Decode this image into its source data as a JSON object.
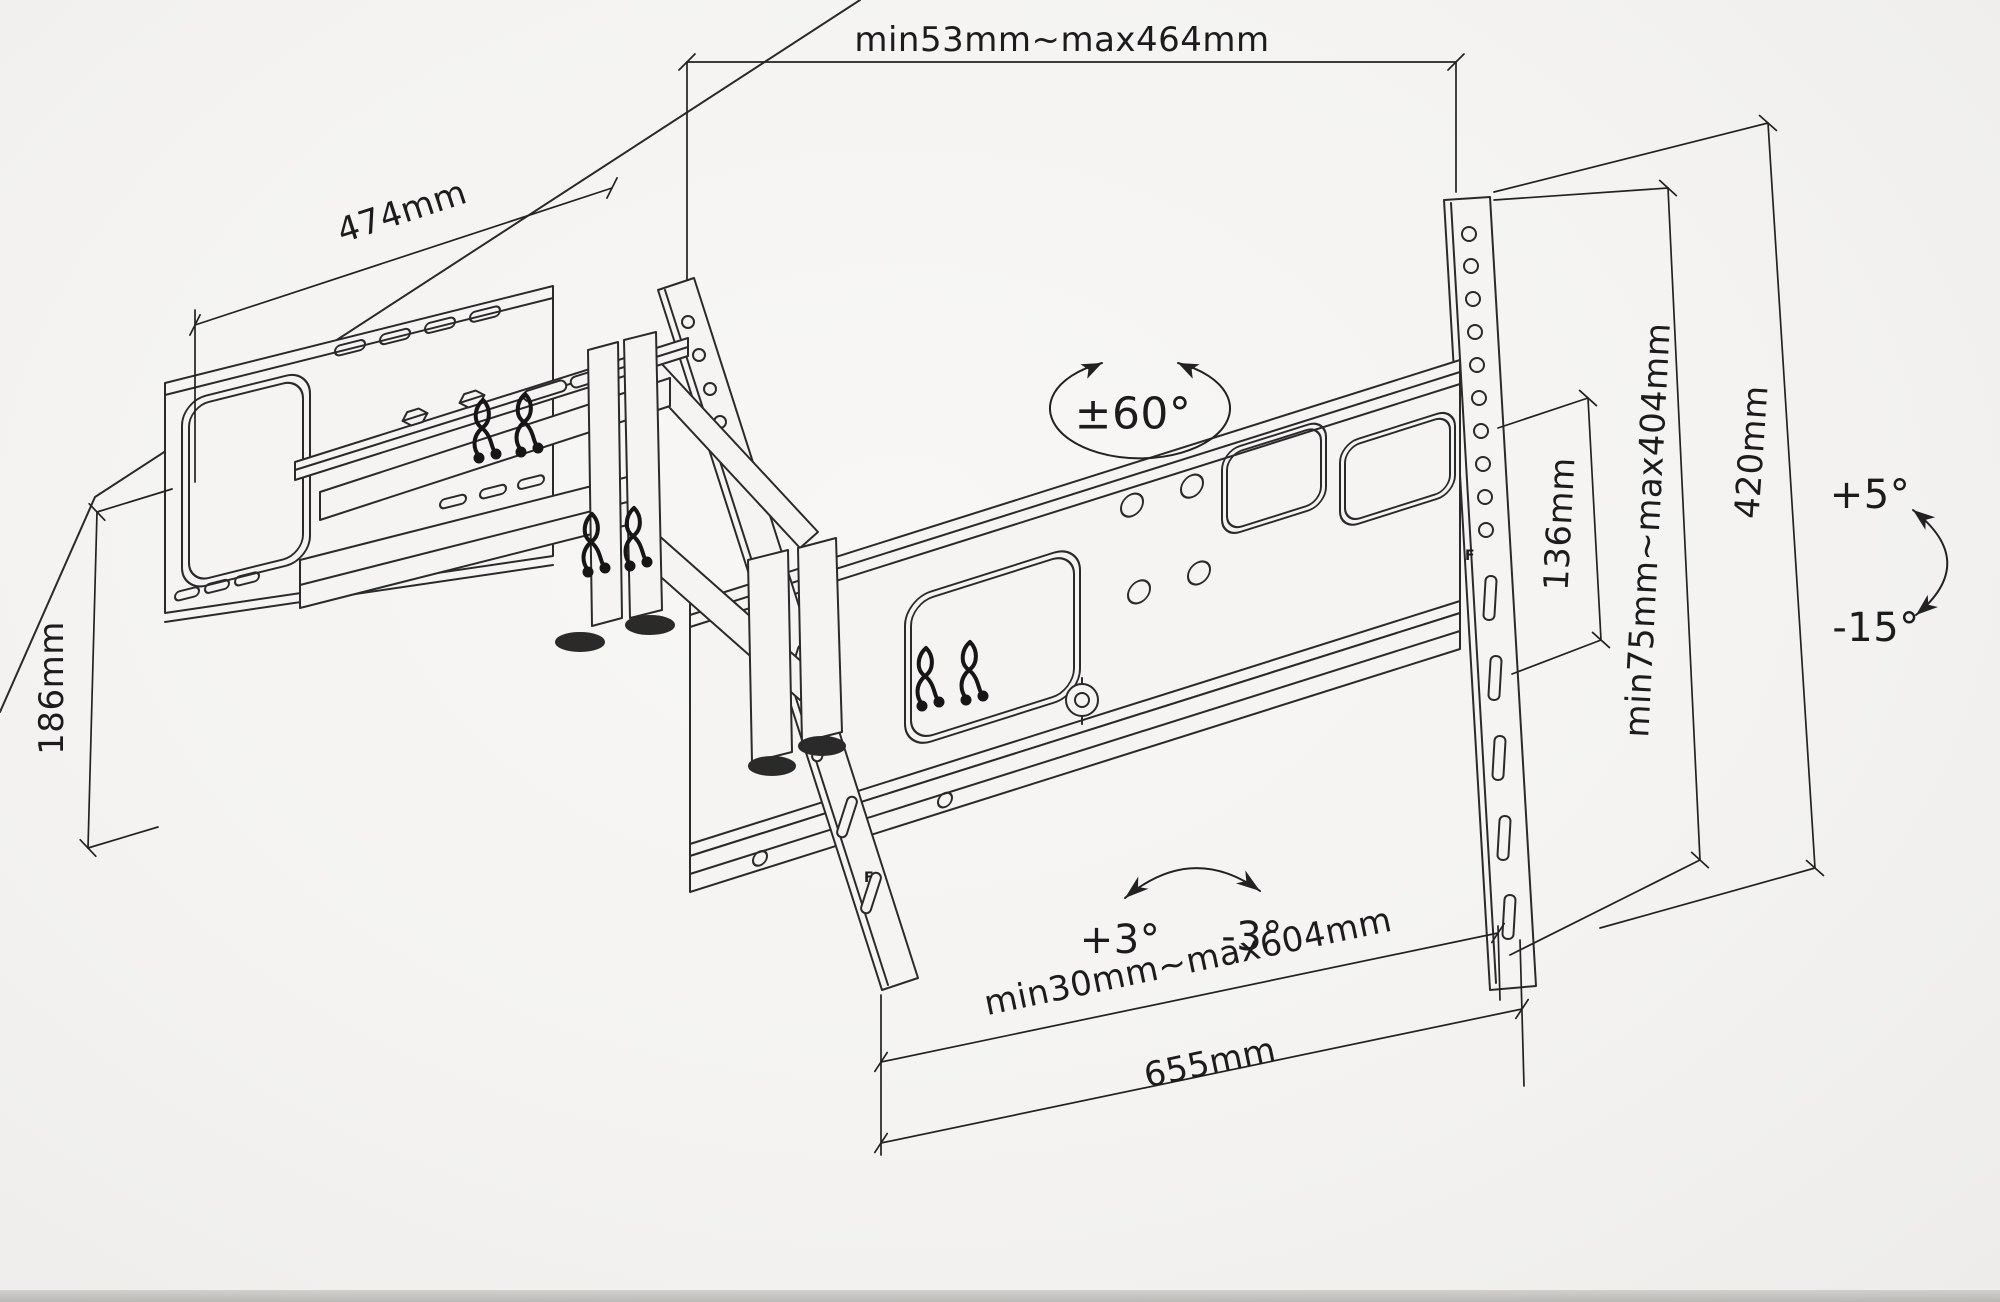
{
  "diagram": {
    "dimensions": {
      "top_span": "min53mm~max464mm",
      "wall_plate_width": "474mm",
      "wall_plate_height": "186mm",
      "swivel_range": "±60°",
      "bracket_end_height": "136mm",
      "vesa_vertical_range": "min75mm~max404mm",
      "rail_height": "420mm",
      "tilt_up": "+5°",
      "tilt_down": "-15°",
      "level_adjust_left": "+3°",
      "level_adjust_right": "-3°",
      "vesa_horizontal_range": "min30mm~max604mm",
      "bracket_width": "655mm"
    },
    "markings": {
      "rail_letter": "F"
    }
  }
}
